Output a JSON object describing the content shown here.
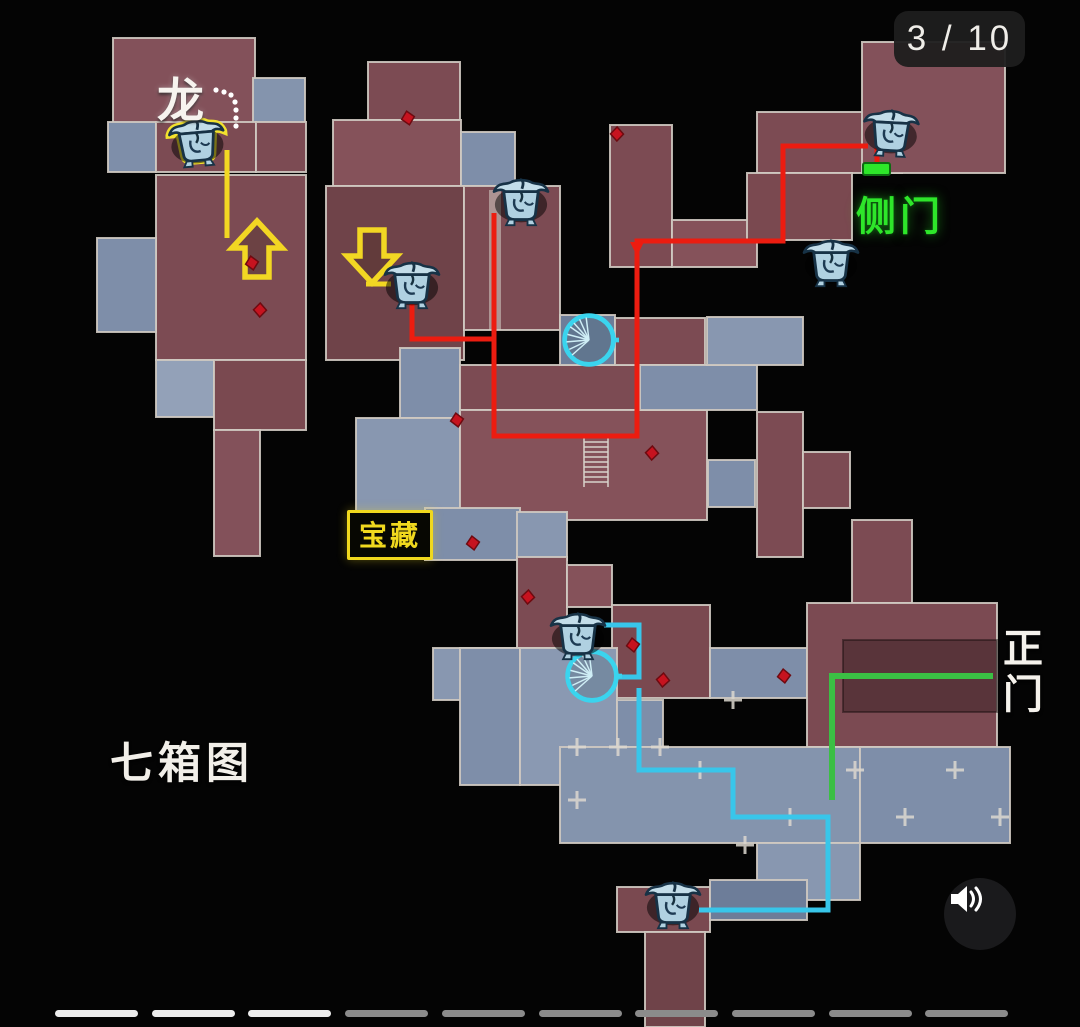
{
  "viewer": {
    "counter": {
      "current": 3,
      "total": 10,
      "display": "3 / 10"
    },
    "pagination": {
      "total": 10,
      "active": 3
    },
    "mute_button": {
      "icon": "volume-icon"
    }
  },
  "map": {
    "title": "七箱图",
    "labels": {
      "dragon": "龙",
      "side_door": "侧门",
      "treasure": "宝藏",
      "main_door": "正门"
    },
    "markers": {
      "chest_count": 7,
      "chest_icon": "treasure-chest-icon",
      "stair_icon": "spiral-stair-icon",
      "gem_icon": "loot-gem-icon",
      "up_arrow": "up-arrow-icon",
      "down_arrow": "down-arrow-icon",
      "side_door_marker": "green-door-marker"
    },
    "colors": {
      "route_red": "#ec1c10",
      "route_cyan": "#38c6ea",
      "route_green": "#3bbf44",
      "route_yellow": "#f2d723",
      "door_green": "#2ee62a",
      "room_red": "#7c4b53",
      "room_blue": "#7e8ea9",
      "chest_blue": "#b0d1e1",
      "background": "#000000"
    }
  }
}
